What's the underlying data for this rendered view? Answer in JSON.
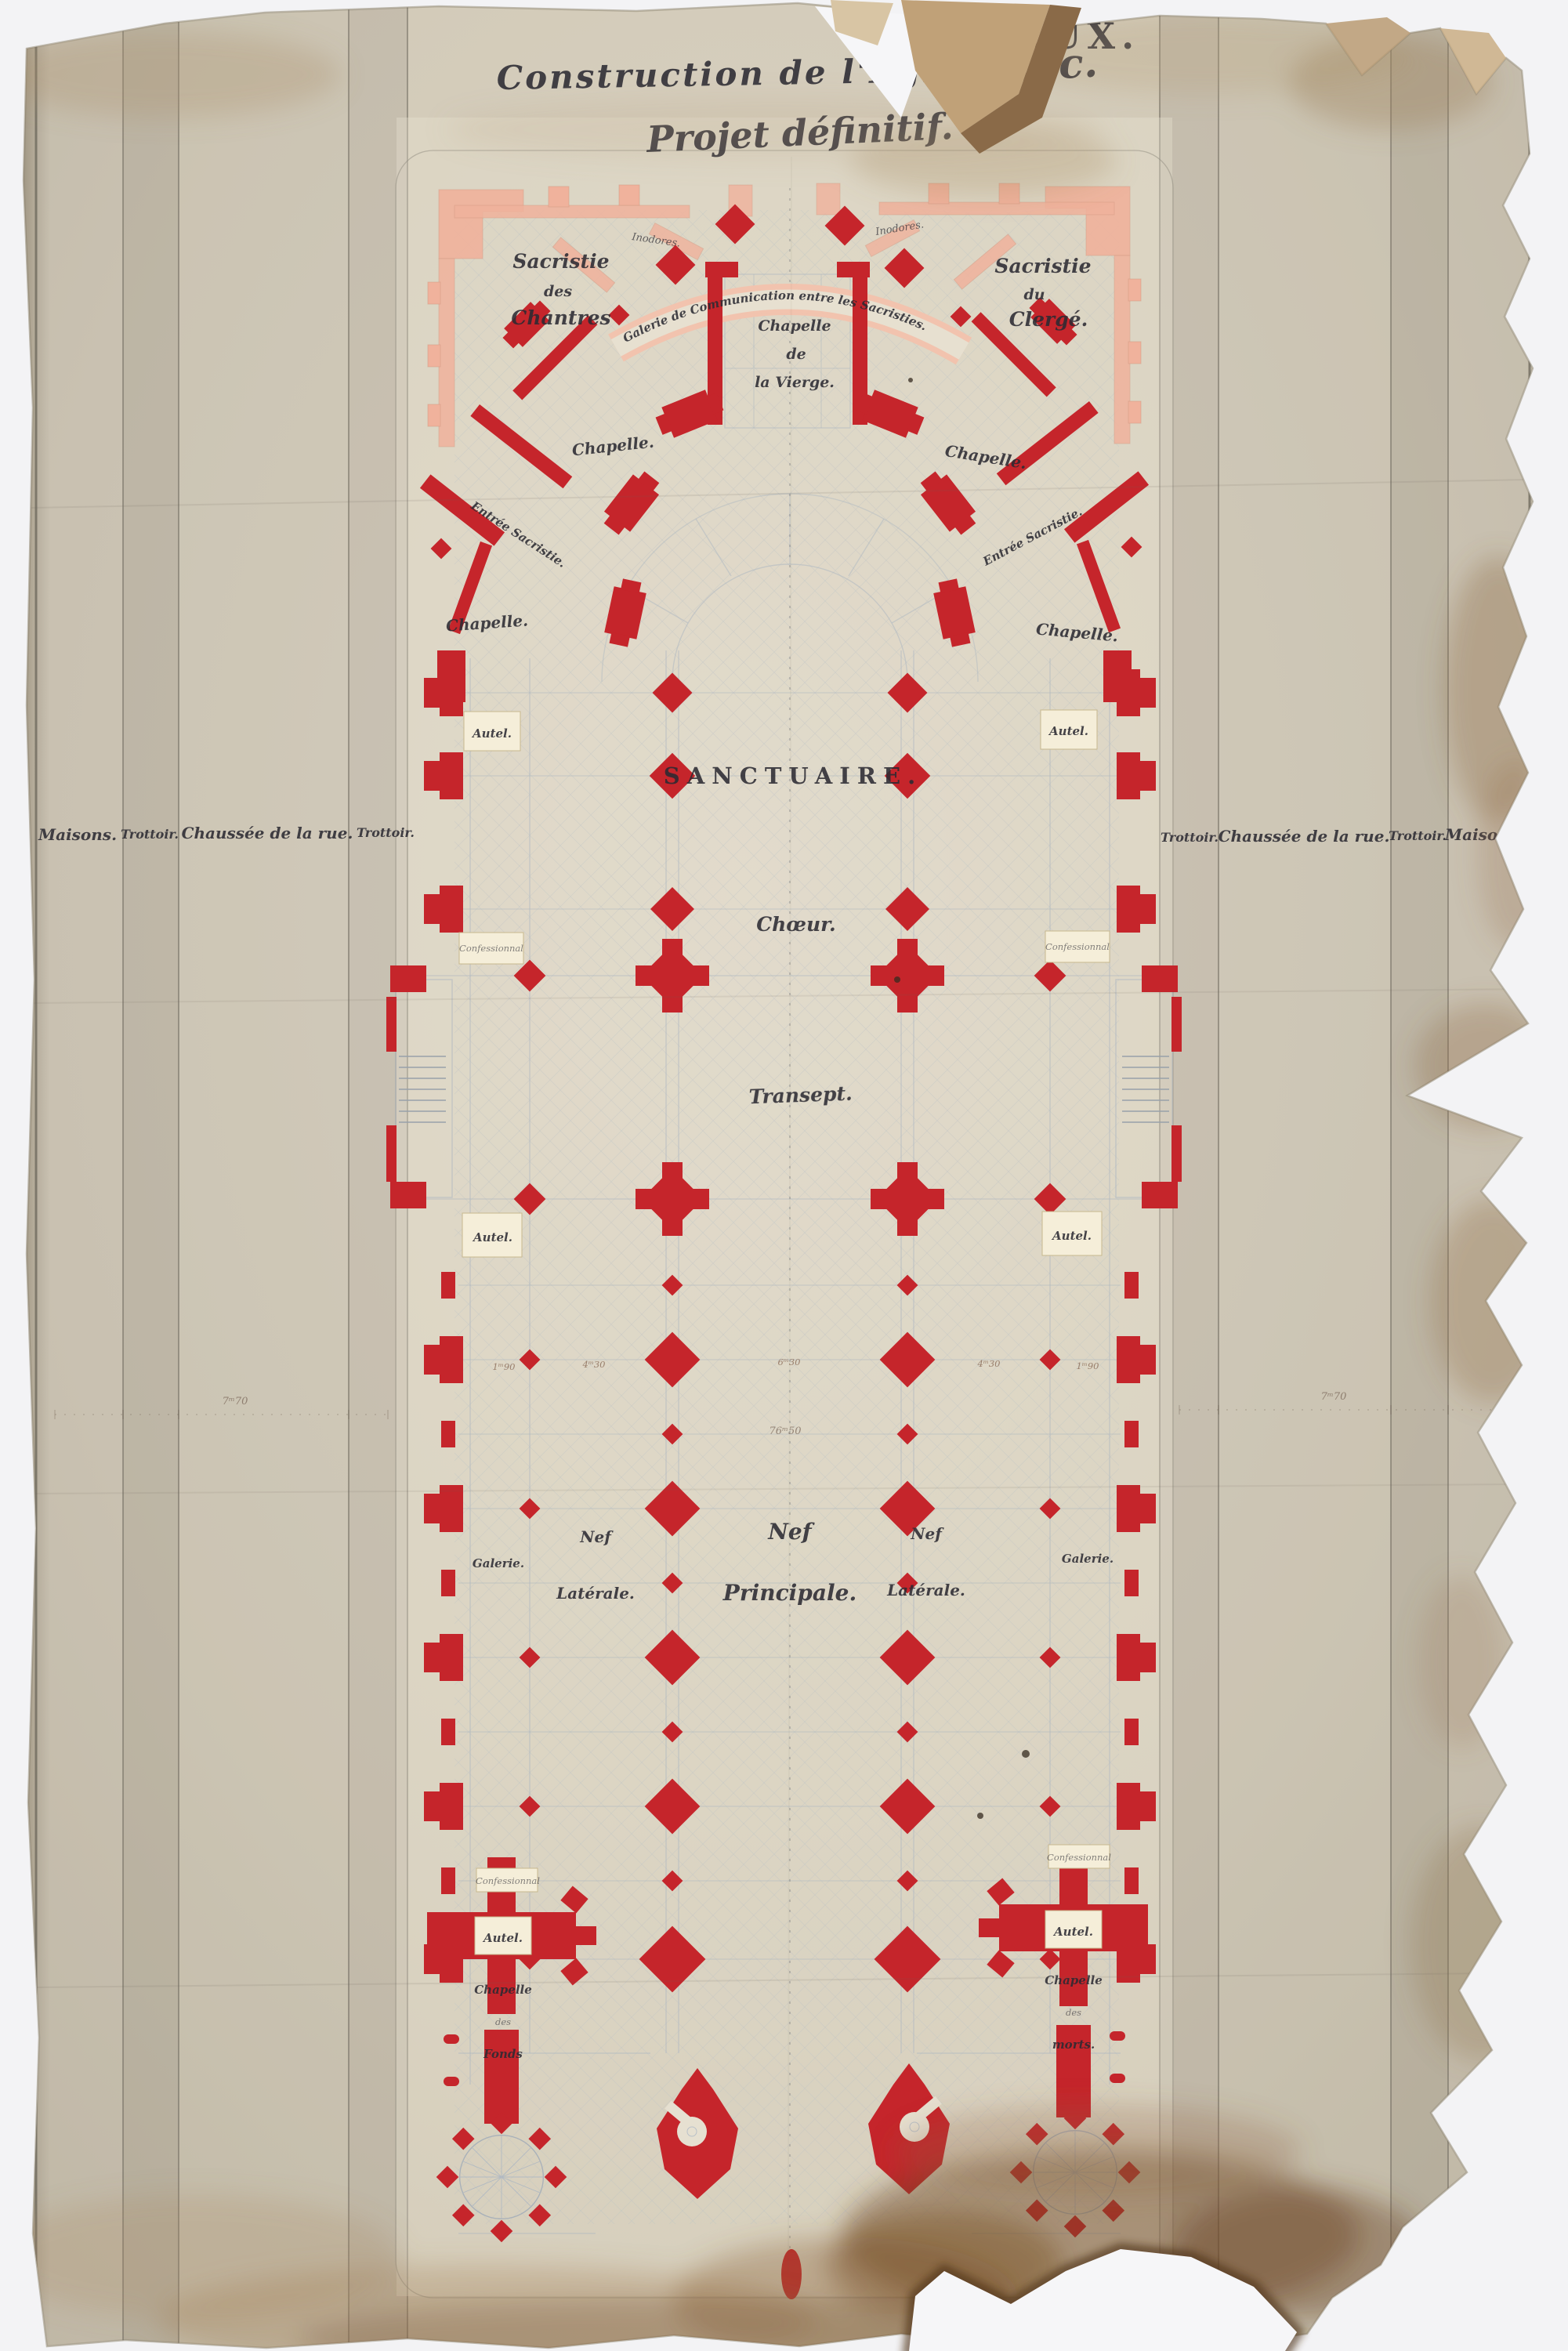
{
  "palette": {
    "red": "#c5252b",
    "pink": "#f0b29c",
    "paper": "#d5cdbb",
    "ink": "#2c2b33",
    "floor_line": "#aeb8c1",
    "cream": "#f5eed9"
  },
  "title": {
    "fragment_top": "ROUX.",
    "line1a": "Construction de l'Eglise",
    "line1b": "St Luc.",
    "line2": "Projet définitif."
  },
  "street": {
    "maisons": "Maisons.",
    "trottoir": "Trottoir.",
    "chaussee": "Chaussée de la rue.",
    "dim_tick": "7ᵐ70"
  },
  "chevet": {
    "sacristie_chantres": {
      "l1": "Sacristie",
      "l2": "des",
      "l3": "Chantres"
    },
    "sacristie_clerge": {
      "l1": "Sacristie",
      "l2": "du",
      "l3": "Clergé."
    },
    "galerie_communication": "Galerie de Communication entre les Sacristies.",
    "inodores": "Inodores.",
    "chapelle_vierge": {
      "l1": "Chapelle",
      "l2": "de",
      "l3": "la Vierge."
    },
    "chapelle": "Chapelle.",
    "entree_sacristie": "Entrée Sacristie."
  },
  "rooms": {
    "sanctuaire": "Sanctuaire.",
    "choeur": "Chœur.",
    "transept": "Transept.",
    "nef_l1": "Nef",
    "nef_principale_l2": "Principale.",
    "nef_laterale_l2": "Latérale.",
    "galerie": "Galerie.",
    "autel": "Autel.",
    "confessionnal": "Confessionnal",
    "chapelle_fonds": {
      "l1": "Chapelle",
      "l2": "des",
      "l3": "Fonds"
    },
    "chapelle_morts": {
      "l1": "Chapelle",
      "l2": "des",
      "l3": "morts."
    }
  },
  "dimensions": {
    "bay_small": "1ᵐ90",
    "bay_mid": "4ᵐ30",
    "bay_large": "6ᵐ30",
    "total_width": "76ᵐ50"
  }
}
